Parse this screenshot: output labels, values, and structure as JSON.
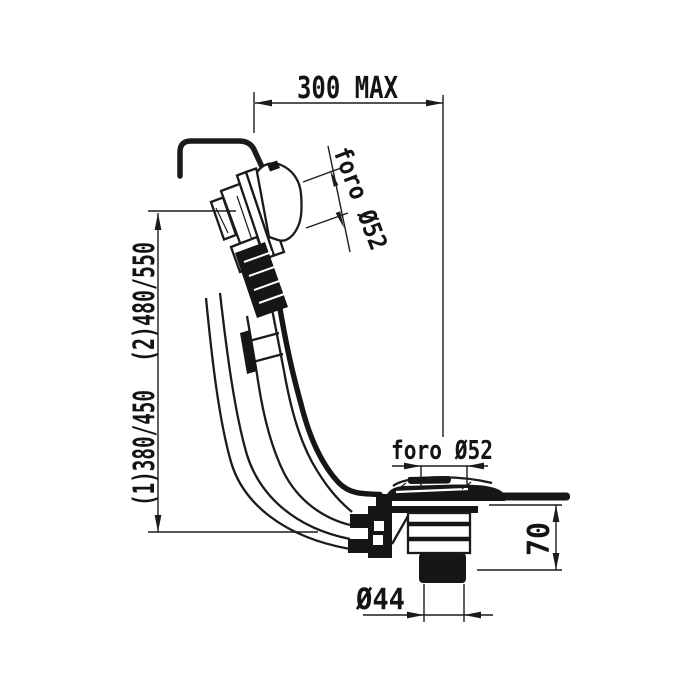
{
  "drawing": {
    "background": "#ffffff",
    "line_color": "#1b1b1b",
    "labels": {
      "top_width": "300 MAX",
      "overflow_hole": "foro Ø52",
      "drain_hole": "foro Ø52",
      "height_option_1": "(1)380/450",
      "height_option_2": "(2)480/550",
      "drain_height": "70",
      "tail_diameter": "Ø44"
    }
  }
}
